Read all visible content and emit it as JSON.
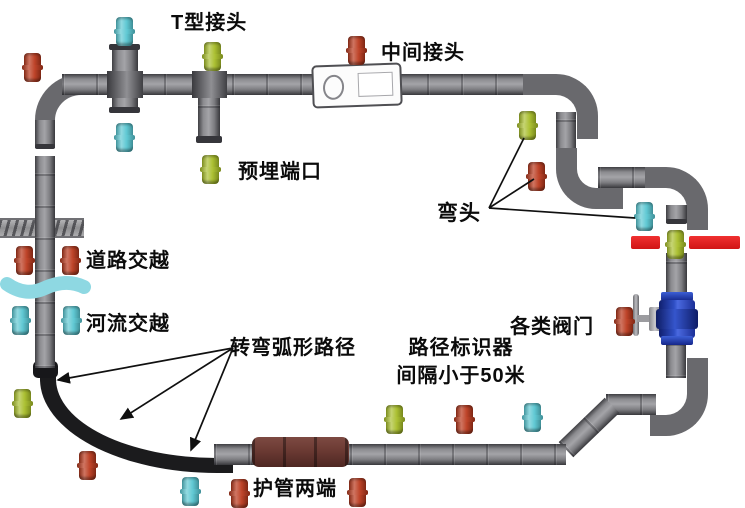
{
  "labels": {
    "t_joint": "T型接头",
    "middle_joint": "中间接头",
    "embedded_port": "预埋端口",
    "road_crossing": "道路交越",
    "river_crossing": "河流交越",
    "elbow": "弯头",
    "valves": "各类阀门",
    "arc_path": "转弯弧形路径",
    "path_marker_line1": "路径标识器",
    "path_marker_line2": "间隔小于50米",
    "duct_ends": "护管两端"
  },
  "colors": {
    "marker_red": "#bb3a1e",
    "marker_cyan": "#58c6d1",
    "marker_green": "#a7bd28",
    "pipe_gray": "#8b8b8f",
    "arc_black": "#1b1b1d",
    "sleeve_maroon": "#6b3a33",
    "crossing_bar_red": "#e01f1f",
    "valve_blue": "#2e4ec4",
    "river_cyan": "#8ed8e2"
  },
  "markers": [
    {
      "x": 24,
      "y": 53,
      "color": "red"
    },
    {
      "x": 116,
      "y": 17,
      "color": "cyan"
    },
    {
      "x": 204,
      "y": 42,
      "color": "green"
    },
    {
      "x": 348,
      "y": 36,
      "color": "red"
    },
    {
      "x": 116,
      "y": 123,
      "color": "cyan"
    },
    {
      "x": 202,
      "y": 155,
      "color": "green"
    },
    {
      "x": 519,
      "y": 111,
      "color": "green"
    },
    {
      "x": 528,
      "y": 162,
      "color": "red"
    },
    {
      "x": 636,
      "y": 202,
      "color": "cyan"
    },
    {
      "x": 667,
      "y": 230,
      "color": "green"
    },
    {
      "x": 616,
      "y": 307,
      "color": "red"
    },
    {
      "x": 16,
      "y": 246,
      "color": "red"
    },
    {
      "x": 62,
      "y": 246,
      "color": "red"
    },
    {
      "x": 12,
      "y": 306,
      "color": "cyan"
    },
    {
      "x": 63,
      "y": 306,
      "color": "cyan"
    },
    {
      "x": 14,
      "y": 389,
      "color": "green"
    },
    {
      "x": 79,
      "y": 451,
      "color": "red"
    },
    {
      "x": 182,
      "y": 477,
      "color": "cyan"
    },
    {
      "x": 231,
      "y": 479,
      "color": "red"
    },
    {
      "x": 349,
      "y": 478,
      "color": "red"
    },
    {
      "x": 386,
      "y": 405,
      "color": "green"
    },
    {
      "x": 456,
      "y": 405,
      "color": "red"
    },
    {
      "x": 524,
      "y": 403,
      "color": "cyan"
    }
  ],
  "annotation_lines": [
    {
      "name": "elbow-pointer",
      "from": [
        489,
        208
      ],
      "targets": [
        [
          524,
          138
        ],
        [
          534,
          179
        ],
        [
          635,
          218
        ]
      ],
      "arrow": false
    },
    {
      "name": "arc-path-pointer",
      "from": [
        233,
        348
      ],
      "targets": [
        [
          58,
          380
        ],
        [
          121,
          419
        ],
        [
          191,
          450
        ]
      ],
      "arrow": true
    }
  ]
}
